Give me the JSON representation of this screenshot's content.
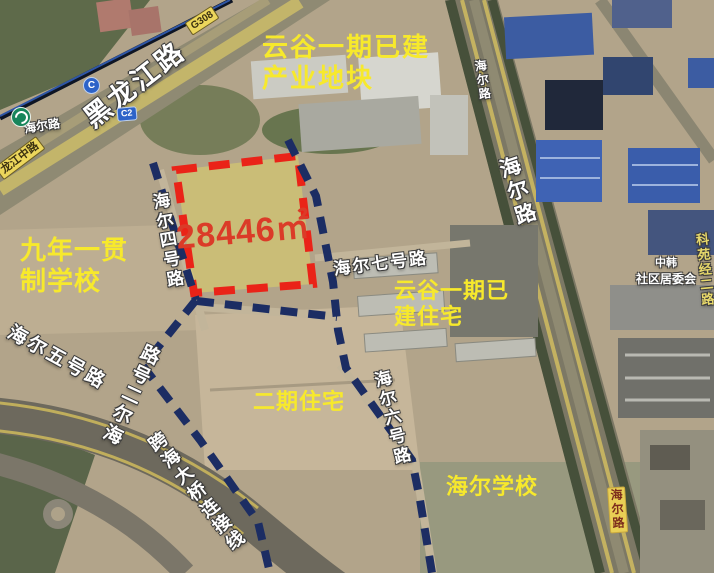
{
  "map": {
    "parcel": {
      "area": "28446㎡",
      "fill_color": "#ded268",
      "border_color": "#ea2318"
    },
    "route_color": "#1c2d63",
    "label_color": "#f7e92c",
    "area_labels": {
      "yungu_industrial": {
        "line1": "云谷一期已建",
        "line2": "产业地块"
      },
      "nine_year_school": {
        "line1": "九年一贯",
        "line2": "制学校"
      },
      "yungu_residential": {
        "line1": "云谷一期已",
        "line2": "建住宅"
      },
      "phase2_residential": "二期住宅",
      "haier_school": "海尔学校"
    },
    "road_labels": {
      "heilongjiang_road": "黑龙江路",
      "heilongjiang_middle_road": "龙江中路",
      "g308_badge": "G308",
      "haier_road_nw": "海尔路",
      "haier_road_upper": "海尔路",
      "haier_road_mid": "海尔路",
      "haier_road_lower": "海尔路",
      "haier_2nd_road": "海尔二号路",
      "haier_4th_road": "海尔四号路",
      "haier_5th_road": "海尔五号路",
      "haier_6th_road": "海尔六号路",
      "haier_7th_road": "海尔七号路",
      "bridge_connector": "跨海大桥连接线",
      "keyuan_jing_2nd_road": "科苑经二路"
    },
    "markers": {
      "line_c": "C",
      "line_c2": "C2",
      "community_line1": "中韩",
      "community_line2": "社区居委会"
    }
  }
}
